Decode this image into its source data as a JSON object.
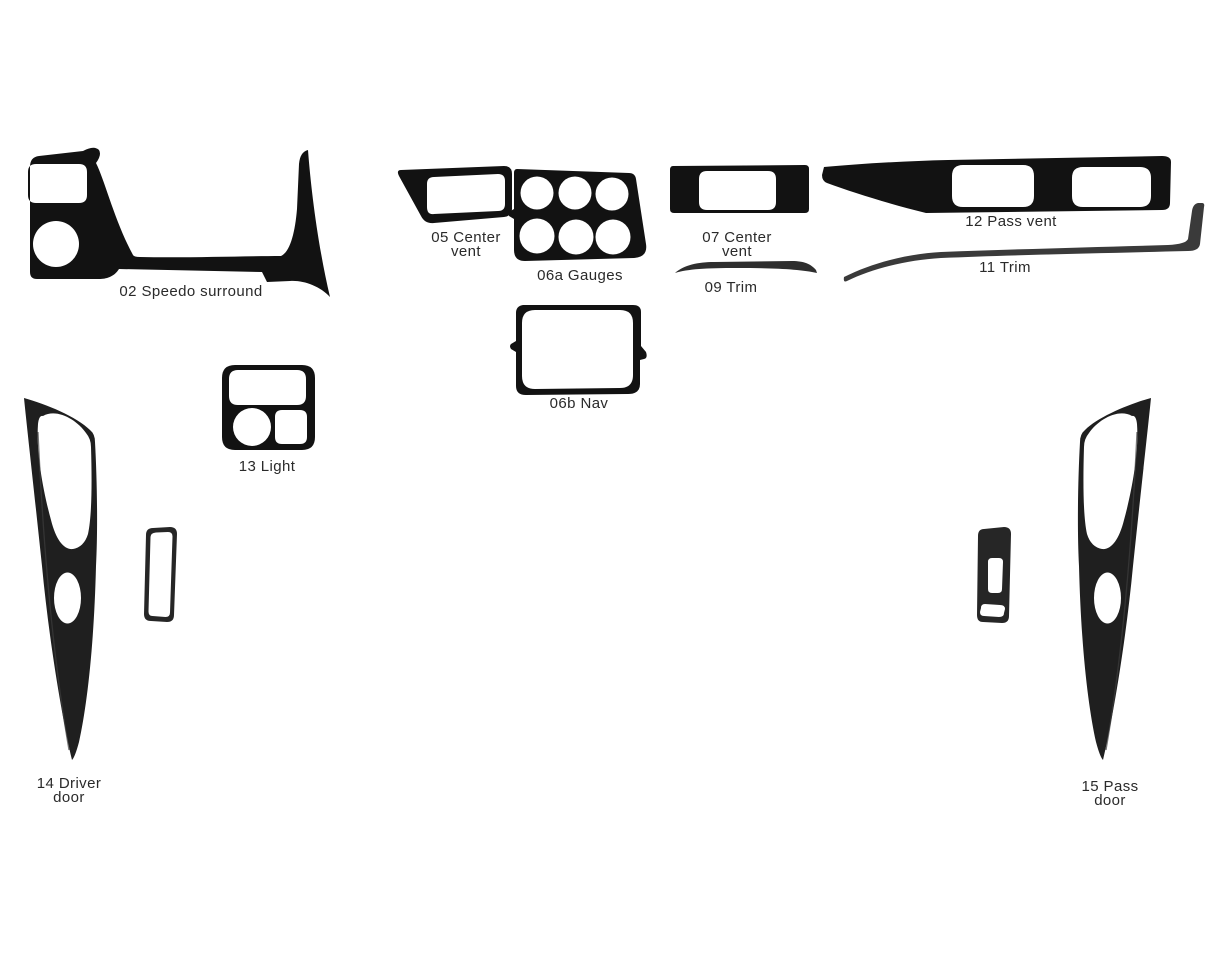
{
  "canvas": {
    "width": 1228,
    "height": 955,
    "background": "#ffffff"
  },
  "diagram": {
    "kind": "vehicle dash trim kit parts diagram",
    "colors": {
      "background": "#ffffff",
      "part_fill": "#121212",
      "door_fill": "#1f1f1f",
      "small_part_fill": "#262626",
      "trim_09_fill": "#2e2e2e",
      "trim_11_fill": "#3a3a3a",
      "label_text": "#2a2a2a"
    },
    "parts": {
      "speedo_surround_02": {
        "part_number": "02",
        "part_name": "Speedo surround",
        "label_lines": [
          "02 Speedo surround"
        ]
      },
      "center_vent_05": {
        "part_number": "05",
        "part_name": "Center vent",
        "label_lines": [
          "05 Center",
          "vent"
        ]
      },
      "gauges_06a": {
        "part_number": "06a",
        "part_name": "Gauges",
        "label_lines": [
          "06a Gauges"
        ]
      },
      "center_vent_07": {
        "part_number": "07",
        "part_name": "Center vent",
        "label_lines": [
          "07 Center",
          "vent"
        ]
      },
      "trim_09": {
        "part_number": "09",
        "part_name": "Trim",
        "label_lines": [
          "09 Trim"
        ]
      },
      "trim_11": {
        "part_number": "11",
        "part_name": "Trim",
        "label_lines": [
          "11 Trim"
        ]
      },
      "pass_vent_12": {
        "part_number": "12",
        "part_name": "Pass vent",
        "label_lines": [
          "12 Pass vent"
        ]
      },
      "nav_06b": {
        "part_number": "06b",
        "part_name": "Nav",
        "label_lines": [
          "06b Nav"
        ]
      },
      "light_13": {
        "part_number": "13",
        "part_name": "Light",
        "label_lines": [
          "13 Light"
        ]
      },
      "driver_door_14": {
        "part_number": "14",
        "part_name": "Driver door",
        "label_lines": [
          "14 Driver",
          "door"
        ]
      },
      "pass_door_15": {
        "part_number": "15",
        "part_name": "Pass door",
        "label_lines": [
          "15 Pass",
          "door"
        ]
      }
    }
  }
}
